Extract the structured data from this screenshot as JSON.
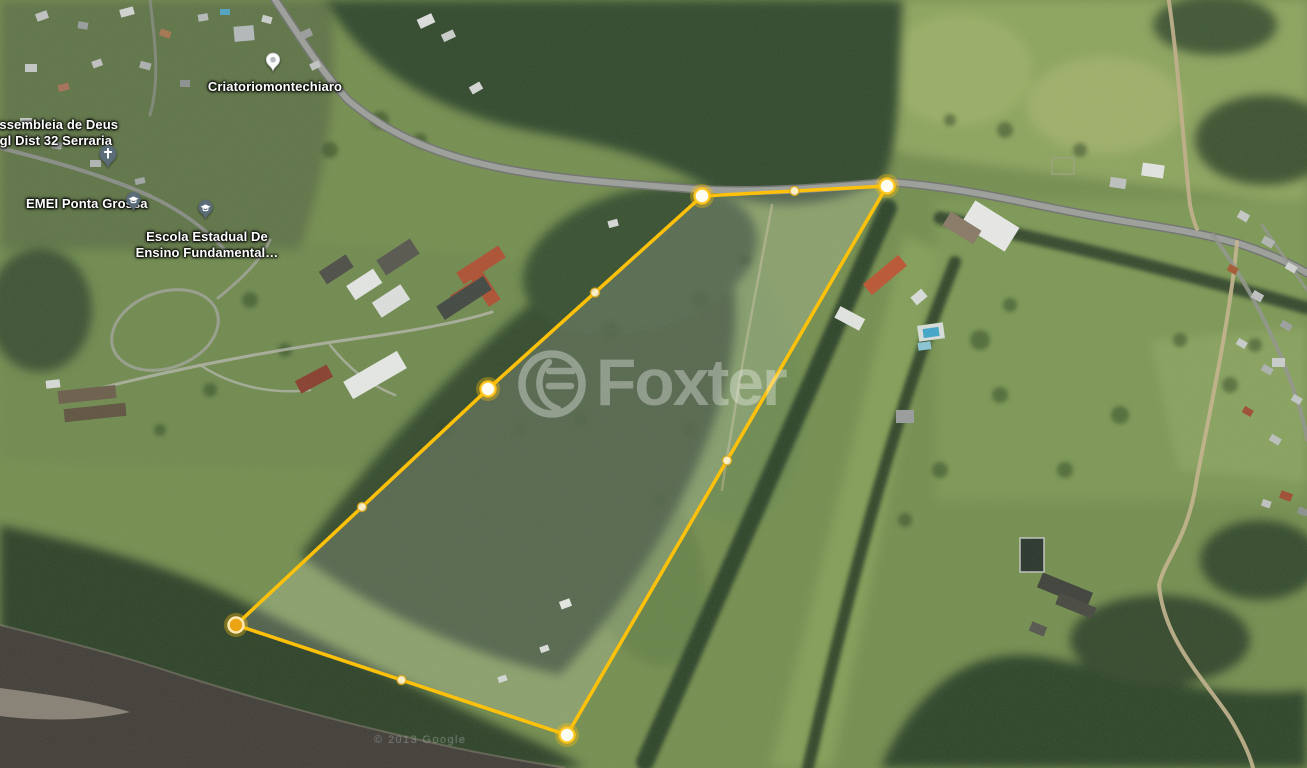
{
  "map": {
    "labels": {
      "assembleia_line1": "Assembleia de Deus",
      "assembleia_line2": "Igl Dist 32 Serraria",
      "emei": "EMEI Ponta Grossa",
      "escola_line1": "Escola Estadual De",
      "escola_line2": "Ensino Fundamental…",
      "criatorio": "Criatoriomontechiaro"
    },
    "watermark": {
      "brand": "Foxter"
    },
    "credit": {
      "imagery": "© 2013 Google"
    },
    "icons": {
      "church_pin": "church-pin",
      "school_pin": "graduation-cap-pin",
      "place_pin": "place-pin",
      "brand_logo": "foxter-logo-ring"
    },
    "colors": {
      "boundary_stroke": "#FFC10A",
      "boundary_fill": "rgba(255,255,255,0.16)",
      "vertex_fill": "#FFFEF2",
      "vertex_ring": "rgba(255,196,20,0.9)",
      "vertex_glow": "rgba(255,193,10,0.35)",
      "active_vertex_fill": "#ECA414",
      "active_vertex_ring": "#FFE9B0",
      "midpoint_fill": "rgba(255,248,225,0.85)",
      "midpoint_ring": "rgba(224,164,0,0.7)",
      "water": "#3F3B37",
      "pin_fill": "#5B6C79",
      "pin_glyph": "#FFFFFF",
      "place_pin_fill": "#FCFCFC"
    }
  }
}
